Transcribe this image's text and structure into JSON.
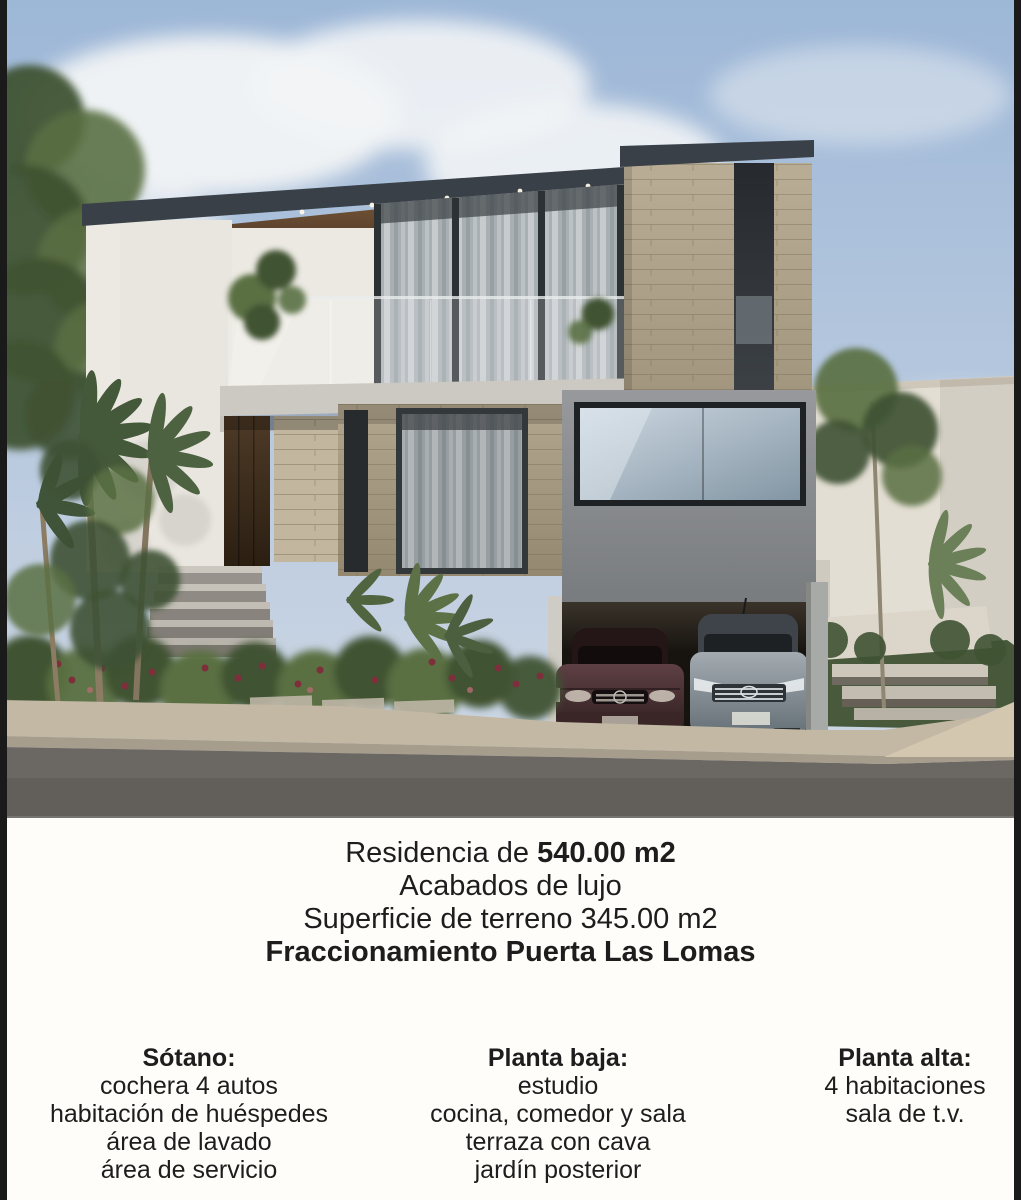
{
  "flyer": {
    "line1": {
      "normal": "Residencia de ",
      "bold": "540.00 m2"
    },
    "line2": "Acabados de lujo",
    "line3": "Superficie de terreno 345.00 m2",
    "line4": "Fraccionamiento Puerta Las Lomas",
    "columns": [
      {
        "header": "Sótano:",
        "items": [
          "cochera 4 autos",
          "habitación de huéspedes",
          "área de lavado",
          "área de servicio"
        ]
      },
      {
        "header": "Planta baja:",
        "items": [
          "estudio",
          "cocina, comedor y sala",
          "terraza con cava",
          "jardín posterior"
        ]
      },
      {
        "header": "Planta alta:",
        "items": [
          "4 habitaciones",
          "sala de t.v."
        ]
      }
    ]
  },
  "photo": {
    "palette": {
      "sky_top": "#9db7d7",
      "sky_bottom": "#cdd7e4",
      "cloud": "#f2f4f6",
      "roof_dark": "#394048",
      "wood_soffit": "#6e5136",
      "wall_white": "#e9e6df",
      "stone": "#b3a78f",
      "concrete_slab": "#ccc9c2",
      "gray_volume": "#8b8e90",
      "garage_dark": "#17140f",
      "glass": "#aab1b5",
      "foliage_dark": "#3f5233",
      "foliage_light": "#5a7042",
      "flower_red": "#7e2f3c",
      "sidewalk": "#c3b8a4",
      "street": "#6b6762",
      "border_black": "#1a1a1a"
    }
  }
}
